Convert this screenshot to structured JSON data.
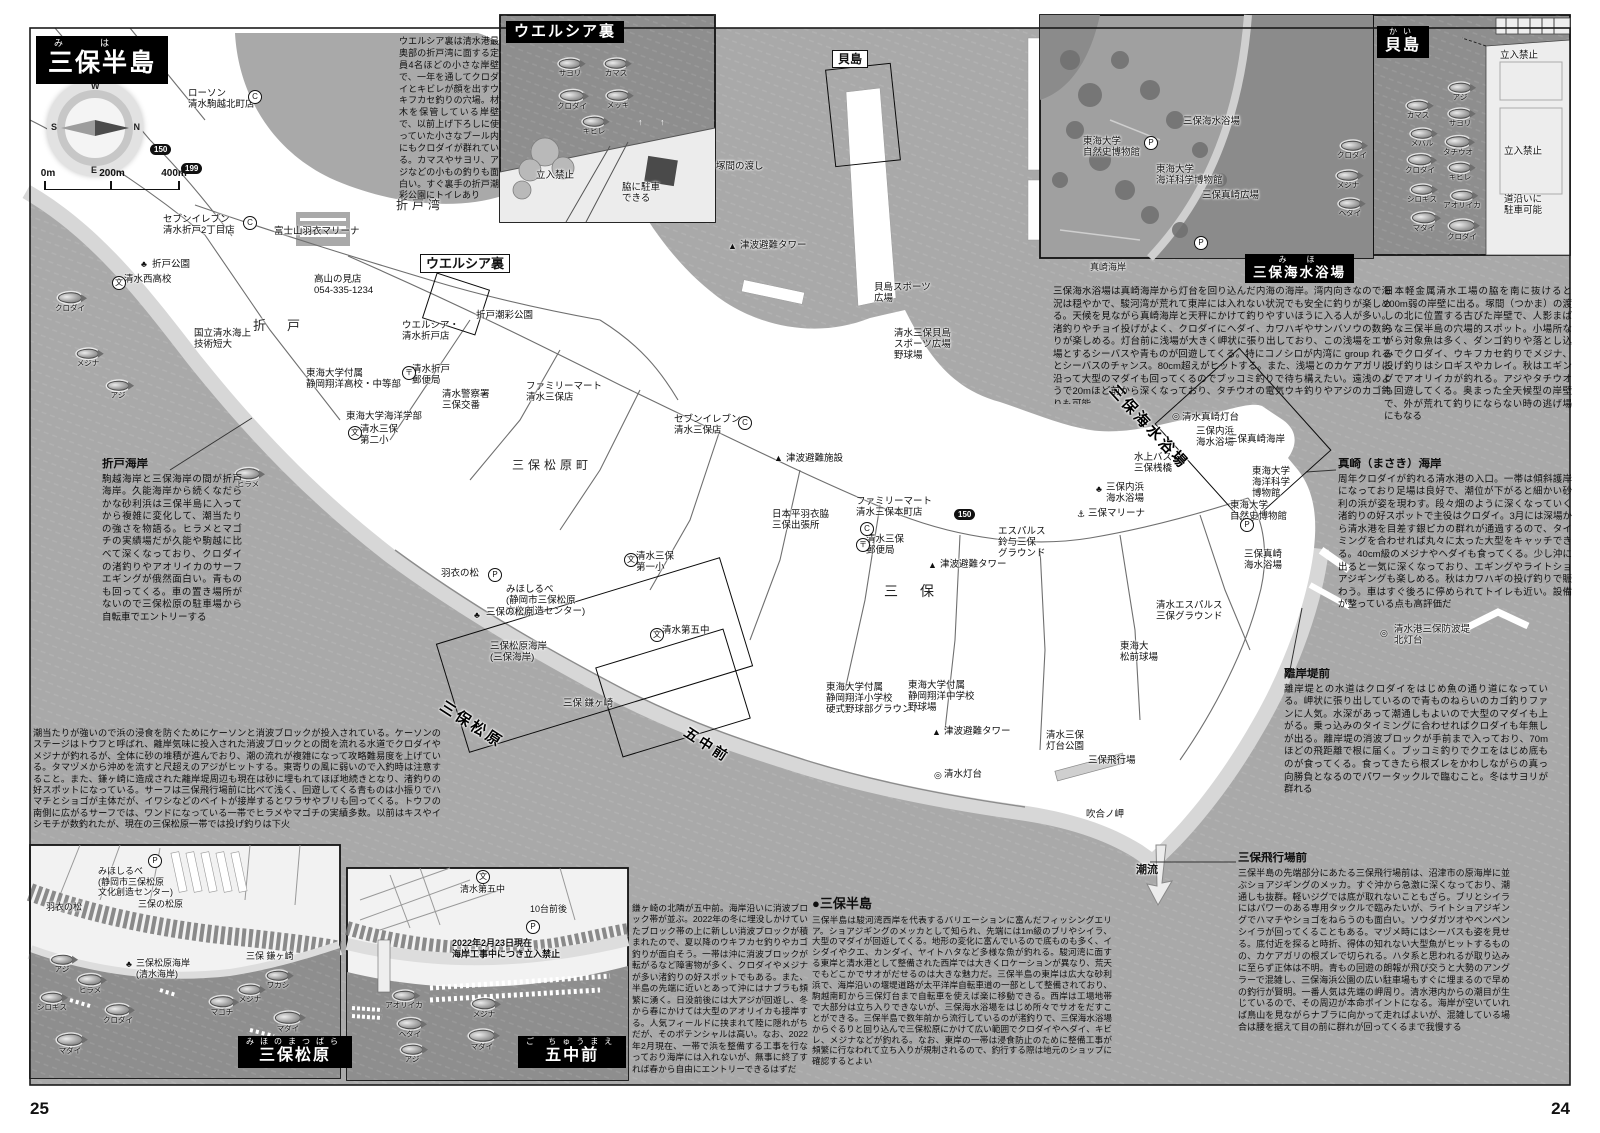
{
  "page_numbers": {
    "left": "25",
    "right": "24"
  },
  "title_block": {
    "furigana": "み　は",
    "title": "三保半島"
  },
  "compass": {
    "n": "N",
    "e": "E",
    "s": "S",
    "w": "W"
  },
  "scale_bar": {
    "t0": "0m",
    "t1": "200m",
    "t2": "400m"
  },
  "colors": {
    "water": "#a9a9a9",
    "inset_water": "#8e8e8e",
    "land": "#ffffff",
    "beach": "#d7d7d7",
    "ink": "#111111"
  },
  "inset_titles": {
    "welcia": {
      "title": "ウエルシア裏"
    },
    "kaijima": {
      "furigana": "かい",
      "title": "貝島"
    },
    "beach": {
      "furigana": "み　ほ",
      "title": "三保海水浴場"
    },
    "matsubara": {
      "furigana": "みほのまつばら",
      "title": "三保松原"
    },
    "gochumae": {
      "furigana": "ご ちゅうまえ",
      "title": "五中前"
    }
  },
  "blocks": {
    "welcia": {
      "body": "ウエルシア裏は清水港最奥部の折戸湾に面する定員4名ほどの小さな岸壁で、一年を通してクロダイとキビレが顔を出すウキフカセ釣りの穴場。材木を保管している岸壁で、以前上げ下ろしに使っていた小さなプール内にもクロダイが群れている。カマスやサヨリ、アジなどの小もの釣りも面白い。すぐ裏手の折戸潮彩公園にトイレあり"
    },
    "kaijima": {
      "body": "日本軽金属清水工場の脇を南に抜けると200m弱の岸壁に出る。塚間（つかま）の渡しの北に位置する古びた岸壁で、人影まばらな三保半島の穴場的スポット。小場所ながら対象魚は多く、ダンゴ釣りや落とし込みでクロダイ、ウキフカセ釣りでメジナ、投げ釣りはシロギスやカレイ。秋はエギングでアオリイカが釣れる。アジやタチウオも回遊してくる。奥まった全天候型の岸壁で、外が荒れて釣りにならない時の逃げ場にもなる"
    },
    "beach": {
      "body": "三保海水浴場は真崎海岸から灯台を回り込んだ内海の海岸。湾内向きなので海況は穏やかで、駿河湾が荒れて東岸には入れない状況でも安全に釣りが楽しめる。天候を見ながら真崎海岸と天秤にかけて釣りやすいほうに入る人が多い。渚釣りやチョイ投げがよく、クロダイにヘダイ、カワハギやサンバソウの数釣りが楽しめる。灯台前に浅場が大きく岬状に張り出しており、この浅場をエサ場とするシーバスや青ものが回遊してくる。特にコノシロが内湾に group れるとシーバスのチャンス。80cm超えがヒットする。また、浅場とのカケアガリに沿って大型のマダイも回ってくるのでブッコミ釣りで待ち構えたい。遠浅のようで20mほど前から深くなっており、タチウオの電気ウキ釣りやアジのカゴ釣りも可能"
    },
    "masaki": {
      "heading": "真崎（まさき）海岸",
      "body": "周年クロダイが釣れる清水港の入口。一帯は傾斜護岸になっており足場は良好で、潮位が下がると細かい砂利の浜が姿を現わす。段々畑のように深くなっていく渚釣りの好スポットで主役はクロダイ。3月には深場から清水港を目差す銀ピカの群れが通過するので、タイミングを合わせれば丸々に太った大型をキャッチできる。40cm級のメジナやヘダイも食ってくる。少し沖に出ると一気に深くなっており、エギングやライトショアジギングも楽しめる。秋はカワハギの投げ釣りで賑わう。車はすぐ後ろに停められてトイレも近い。設備が整っている点も高評価だ"
    },
    "rigantei": {
      "heading": "離岸堤前",
      "body": "離岸堤との水道はクロダイをはじめ魚の通り道になっている。岬状に張り出しているので青ものねらいのカゴ釣りファンに人気。水深があって潮通しもよいので大型のマダイも上がる。乗っ込みのタイミングに合わせればクロダイも年無しが出る。離岸堤の消波ブロックが手前まで入っており、70mほどの飛距離で根に届く。ブッコミ釣りでクエをはじめ底ものが食ってくる。食ってきたら根ズレをかわしながらの真っ向勝負となるのでパワータックルで臨むこと。冬はサヨリが群れる"
    },
    "airfield": {
      "heading": "三保飛行場前",
      "body": "三保半島の先端部分にあたる三保飛行場前は、沼津市の原海岸に並ぶショアジギングのメッカ。すぐ沖から急激に深くなっており、潮通しも抜群。軽いジグでは底が取れないこともざら。ブリとシイラにはパワーのある専用タックルで臨みたいが、ライトショアジギングでハマチやショゴをねらうのも面白い。ソウダガツオやペンペンシイラが回ってくることもある。マヅメ時にはシーバスも姿を見せる。底付近を探ると時折、得体の知れない大型魚がヒットするものの、カケアガリの根ズレで切られる。ハタ系と思われるが取り込みに至らず正体は不明。青もの回遊の朗報が飛び交うと大勢のアングラーで混雑し、三保海浜公園の広い駐車場もすぐに埋まるので早めの釣行が賢明。一番人気は先端の岬周り。清水港内からの潮目が生じているので、その周辺が本命ポイントになる。海岸が空いていれば鳥山を見ながらナブラに向かって走ればよいが、混雑している場合は腰を据えて目の前に群れが回ってくるまで我慢する"
    },
    "orido": {
      "heading": "折戸海岸",
      "body": "駒越海岸と三保海岸の間が折戸海岸。久能海岸から続くなだらかな砂利浜は三保半島に入ってから複雑に変化して、潮当たりの強さを物語る。ヒラメとマゴチの実績場だが久能や駒越に比べて深くなっており、クロダイの渚釣りやアオリイカのサーフエギングが俄然面白い。青ものも回ってくる。車の置き場所がないので三保松原の駐車場から自転車でエントリーする"
    },
    "matsubara": {
      "body": "潮当たりが強いので浜の浸食を防ぐためにケーソンと消波ブロックが投入されている。ケーソンのステージはトウフと呼ばれ、離岸気味に投入された消波ブロックとの間を流れる水道でクロダイやメジナが釣れるが、全体に砂の堆積が進んでおり、潮の流れが複雑になって攻略難易度を上げている。タマヅメから沖めを流すと尺超えのアジがヒットする。東寄りの風に弱いので入釣時は注意すること。また、鎌ヶ崎に造成された離岸堤周辺も現在は砂に埋もれてほぼ地続きとなり、渚釣りの好スポットになっている。サーフは三保飛行場前に比べて浅く、回遊してくる青ものは小振りでハマチとショゴが主体だが、イワシなどのベイトが接岸するとワラサやブリも回ってくる。トウフの南側に広がるサーフでは、ワンドになっている一帯でヒラメやマゴチの実績多数。以前はキスやイシモチが数釣れたが、現在の三保松原一帯では投げ釣りは下火"
    },
    "gochumae": {
      "body": "鎌ヶ崎の北隣が五中前。海岸沿いに消波ブロック帯が並ぶ。2022年の冬に埋没しかけていたブロック帯の上に新しい消波ブロックが積まれたので、夏以降のウキフカセ釣りやカゴ釣りが面白そう。一帯は沖に消波ブロックが転がるなど障害物が多く、クロダイやメジナが多い渚釣りの好スポットでもある。また、半島の先端に近いとあって沖にはナブラも頻繁に湧く。日没前後には大アジが回遊し、冬から春にかけては大型のアオリイカも接岸する。人気フィールドに挟まれて陸に隠れがちだが、そのポテンシャルは高い。なお、2022年2月現在、一帯で浜を整備する工事を行なっており海岸には入れないが、無事に終了すれば春から自由にエントリーできるはずだ"
    },
    "miho": {
      "heading": "●三保半島",
      "body": "三保半島は駿河湾西岸を代表するバリエーションに富んだフィッシングエリア。ショアジギングのメッカとして知られ、先端には1m級のブリやシイラ、大型のマダイが回遊してくる。地形の変化に富んでいるので底ものも多く、イシダイやクエ、カンダイ、ヤイトハタなど多様な魚が釣れる。駿河湾に面する東岸と清水港として整備された西岸では大きくロケーションが異なり、荒天でもどこかでサオがだせるのは大きな魅力だ。三保半島の東岸は広大な砂利浜で、海岸沿いの堰堤道路が太平洋岸自転車道の一部として整備されており、駒越南町から三保灯台まで自転車を使えば楽に移動できる。西岸は工場地帯で大部分は立ち入りできないが、三保海水浴場をはじめ所々でサオをだすことができる。三保半島で数年前から流行しているのが渚釣りで、三保海水浴場からぐるりと回り込んで三保松原にかけて広い範囲でクロダイやヘダイ、キビレ、メジナなどが釣れる。なお、東岸の一帯は浸食防止のために整備工事が頻繁に行なわれて立ち入りが規制されるので、釣行する際は地元のショップに確認するとよい"
    }
  },
  "map_labels": [
    {
      "t": "ローソン\n清水駒越北町店",
      "x": 188,
      "y": 88
    },
    {
      "t": "セブンイレブン\n清水折戸2丁目店",
      "x": 163,
      "y": 214
    },
    {
      "t": "折戸公園",
      "x": 152,
      "y": 259
    },
    {
      "t": "清水西高校",
      "x": 124,
      "y": 274
    },
    {
      "t": "富士山羽衣マリーナ",
      "x": 274,
      "y": 226
    },
    {
      "t": "高山の見店\n054-335-1234",
      "x": 314,
      "y": 274
    },
    {
      "t": "折　戸",
      "x": 253,
      "y": 318,
      "fs": 13,
      "c": "sp"
    },
    {
      "t": "ウエルシア裏",
      "x": 420,
      "y": 254,
      "fs": 13,
      "c": "b bx",
      "n": "welcia-map-tag"
    },
    {
      "t": "ウエルシア・\n清水折戸店",
      "x": 402,
      "y": 320
    },
    {
      "t": "折戸潮彩公園",
      "x": 476,
      "y": 310
    },
    {
      "t": "折戸湾",
      "x": 396,
      "y": 198,
      "fs": 12,
      "c": "sp"
    },
    {
      "t": "国立清水海上\n技術短大",
      "x": 194,
      "y": 328
    },
    {
      "t": "東海大学付属\n静岡翔洋高校・中等部",
      "x": 306,
      "y": 368
    },
    {
      "t": "東海大学海洋学部",
      "x": 346,
      "y": 411
    },
    {
      "t": "清水折戸\n郵便局",
      "x": 412,
      "y": 364
    },
    {
      "t": "清水警察署\n三保交番",
      "x": 442,
      "y": 389
    },
    {
      "t": "清水三保\n第二小",
      "x": 360,
      "y": 424
    },
    {
      "t": "ファミリーマート\n清水三保店",
      "x": 526,
      "y": 381
    },
    {
      "t": "セブンイレブン\n清水三保店",
      "x": 674,
      "y": 414
    },
    {
      "t": "三保松原町",
      "x": 512,
      "y": 458,
      "fs": 12,
      "c": "sp"
    },
    {
      "t": "津波避難施設",
      "x": 786,
      "y": 453
    },
    {
      "t": "津波避難タワー",
      "x": 740,
      "y": 240
    },
    {
      "t": "塚間の渡し",
      "x": 716,
      "y": 161
    },
    {
      "t": "貝島",
      "x": 832,
      "y": 50,
      "fs": 12,
      "c": "b bx",
      "n": "kaijima-map-tag"
    },
    {
      "t": "貝島スポーツ\n広場",
      "x": 874,
      "y": 282
    },
    {
      "t": "清水三保貝島\nスポーツ広場\n野球場",
      "x": 894,
      "y": 328
    },
    {
      "t": "日本平羽衣脇\n三保出張所",
      "x": 772,
      "y": 509
    },
    {
      "t": "ファミリーマート\n清水三保本町店",
      "x": 856,
      "y": 496
    },
    {
      "t": "清水三保\n郵便局",
      "x": 866,
      "y": 534
    },
    {
      "t": "エスパルス\n鈴与三保\nグラウンド",
      "x": 998,
      "y": 526
    },
    {
      "t": "津波避難タワー",
      "x": 940,
      "y": 559
    },
    {
      "t": "三保マリーナ",
      "x": 1088,
      "y": 508
    },
    {
      "t": "三保内浜\n海水浴場",
      "x": 1106,
      "y": 482
    },
    {
      "t": "水上バス\n三保桟橋",
      "x": 1134,
      "y": 452
    },
    {
      "t": "三保内浜\n海水浴場",
      "x": 1196,
      "y": 426
    },
    {
      "t": "三保真崎海岸",
      "x": 1228,
      "y": 434
    },
    {
      "t": "清水真崎灯台",
      "x": 1182,
      "y": 412
    },
    {
      "t": "東海大学\n海洋科学\n博物館",
      "x": 1252,
      "y": 466
    },
    {
      "t": "東海大学\n自然史博物館",
      "x": 1230,
      "y": 500
    },
    {
      "t": "清水エスパルス\n三保グラウンド",
      "x": 1156,
      "y": 600
    },
    {
      "t": "三　保",
      "x": 884,
      "y": 583,
      "fs": 14,
      "c": "sp"
    },
    {
      "t": "東海大\n松前球場",
      "x": 1120,
      "y": 641
    },
    {
      "t": "三保真崎\n海水浴場",
      "x": 1244,
      "y": 549
    },
    {
      "t": "清水港三保防波堤\n北灯台",
      "x": 1394,
      "y": 624
    },
    {
      "t": "東海大学付属\n静岡翔洋小学校\n硬式野球部グラウンド",
      "x": 826,
      "y": 682
    },
    {
      "t": "東海大学付属\n静岡翔洋中学校\n野球場",
      "x": 908,
      "y": 680
    },
    {
      "t": "津波避難タワー",
      "x": 944,
      "y": 726
    },
    {
      "t": "清水三保\n灯台公園",
      "x": 1046,
      "y": 730
    },
    {
      "t": "三保飛行場",
      "x": 1088,
      "y": 755
    },
    {
      "t": "清水灯台",
      "x": 944,
      "y": 769
    },
    {
      "t": "吹合ノ岬",
      "x": 1086,
      "y": 809
    },
    {
      "t": "潮流",
      "x": 1136,
      "y": 864,
      "fs": 11,
      "c": "b"
    },
    {
      "t": "羽衣の松",
      "x": 441,
      "y": 568
    },
    {
      "t": "みほしるべ\n(静岡市三保松原\n文化創造センター)",
      "x": 506,
      "y": 584
    },
    {
      "t": "三保の松原",
      "x": 486,
      "y": 607
    },
    {
      "t": "清水第五中",
      "x": 662,
      "y": 625
    },
    {
      "t": "三保松原海岸\n(三保海岸)",
      "x": 490,
      "y": 641
    },
    {
      "t": "三保 鎌ヶ崎",
      "x": 563,
      "y": 698
    },
    {
      "t": "清水三保\n第一小",
      "x": 636,
      "y": 551
    },
    {
      "t": "三保海水浴場",
      "x": 1118,
      "y": 382,
      "rot": 47,
      "fs": 15,
      "c": "dg"
    },
    {
      "t": "三保松原",
      "x": 446,
      "y": 698,
      "rot": 33,
      "fs": 15,
      "c": "dg"
    },
    {
      "t": "五中前",
      "x": 690,
      "y": 724,
      "rot": 33,
      "fs": 14,
      "c": "dg"
    },
    {
      "t": "三保海水浴場",
      "x": 1183,
      "y": 116
    },
    {
      "t": "東海大学\n自然史博物館",
      "x": 1083,
      "y": 136
    },
    {
      "t": "東海大学\n海洋科学博物館",
      "x": 1156,
      "y": 164
    },
    {
      "t": "三保真崎広場",
      "x": 1202,
      "y": 190
    },
    {
      "t": "真崎海岸",
      "x": 1090,
      "y": 262,
      "fs": 9
    },
    {
      "t": "立入禁止",
      "x": 1500,
      "y": 50
    },
    {
      "t": "立入禁止",
      "x": 1504,
      "y": 146
    },
    {
      "t": "道沿いに\n駐車可能",
      "x": 1504,
      "y": 194
    },
    {
      "t": "立入禁止",
      "x": 536,
      "y": 170
    },
    {
      "t": "脇に駐車\nできる",
      "x": 622,
      "y": 182
    },
    {
      "t": "みほしるべ\n(静岡市三保松原\n文化創造センター)",
      "x": 98,
      "y": 866,
      "fs": 9
    },
    {
      "t": "羽衣の松",
      "x": 46,
      "y": 902,
      "fs": 9
    },
    {
      "t": "三保の松原",
      "x": 138,
      "y": 899,
      "fs": 9
    },
    {
      "t": "三保松原海岸\n(清水海岸)",
      "x": 136,
      "y": 958,
      "fs": 9
    },
    {
      "t": "三保 鎌ヶ崎",
      "x": 246,
      "y": 951,
      "fs": 9
    },
    {
      "t": "清水第五中",
      "x": 460,
      "y": 884,
      "fs": 9
    },
    {
      "t": "10台前後",
      "x": 530,
      "y": 904,
      "fs": 9
    },
    {
      "t": "2022年2月23日現在\n海岸工事中につき立入禁止",
      "x": 452,
      "y": 938,
      "fs": 9,
      "c": "b"
    }
  ],
  "fish": [
    {
      "t": "サヨリ",
      "x": 570,
      "y": 68,
      "s": 0.9
    },
    {
      "t": "カマス",
      "x": 616,
      "y": 68,
      "s": 0.9
    },
    {
      "t": "クロダイ",
      "x": 572,
      "y": 100,
      "s": 1
    },
    {
      "t": "メッキ",
      "x": 618,
      "y": 100,
      "s": 0.9
    },
    {
      "t": "キビレ",
      "x": 594,
      "y": 126,
      "s": 0.9
    },
    {
      "t": "アジ",
      "x": 1460,
      "y": 92,
      "s": 0.9
    },
    {
      "t": "カマス",
      "x": 1418,
      "y": 110,
      "s": 0.9
    },
    {
      "t": "サヨリ",
      "x": 1460,
      "y": 118,
      "s": 0.9
    },
    {
      "t": "メバル",
      "x": 1422,
      "y": 138,
      "s": 0.9
    },
    {
      "t": "タチウオ",
      "x": 1458,
      "y": 146,
      "s": 1
    },
    {
      "t": "クロダイ",
      "x": 1420,
      "y": 164,
      "s": 1
    },
    {
      "t": "キビレ",
      "x": 1460,
      "y": 172,
      "s": 0.9
    },
    {
      "t": "シロギス",
      "x": 1422,
      "y": 194,
      "s": 0.9
    },
    {
      "t": "アオリイカ",
      "x": 1462,
      "y": 200,
      "s": 0.9
    },
    {
      "t": "マダイ",
      "x": 1424,
      "y": 222,
      "s": 1
    },
    {
      "t": "クロダイ",
      "x": 1462,
      "y": 230,
      "s": 1.1
    },
    {
      "t": "クロダイ",
      "x": 1352,
      "y": 150,
      "s": 0.9
    },
    {
      "t": "メジナ",
      "x": 1348,
      "y": 180,
      "s": 0.9
    },
    {
      "t": "ヘダイ",
      "x": 1350,
      "y": 208,
      "s": 0.9
    },
    {
      "t": "クロダイ",
      "x": 70,
      "y": 302,
      "s": 1
    },
    {
      "t": "メジナ",
      "x": 88,
      "y": 358,
      "s": 0.9
    },
    {
      "t": "アジ",
      "x": 118,
      "y": 390,
      "s": 0.9
    },
    {
      "t": "ヒラメ",
      "x": 248,
      "y": 478,
      "s": 1
    },
    {
      "t": "アジ",
      "x": 62,
      "y": 964,
      "s": 0.9
    },
    {
      "t": "ヒラメ",
      "x": 90,
      "y": 984,
      "s": 1
    },
    {
      "t": "シロギス",
      "x": 52,
      "y": 1002,
      "s": 0.9
    },
    {
      "t": "クロダイ",
      "x": 118,
      "y": 1014,
      "s": 1
    },
    {
      "t": "マダイ",
      "x": 70,
      "y": 1044,
      "s": 1.1
    },
    {
      "t": "メジナ",
      "x": 250,
      "y": 994,
      "s": 0.9
    },
    {
      "t": "ワカシ",
      "x": 278,
      "y": 980,
      "s": 0.9
    },
    {
      "t": "マゴチ",
      "x": 222,
      "y": 1006,
      "s": 1
    },
    {
      "t": "マダイ",
      "x": 288,
      "y": 1022,
      "s": 1.1
    },
    {
      "t": "アオリイカ",
      "x": 404,
      "y": 1000,
      "s": 0.9
    },
    {
      "t": "ヘダイ",
      "x": 410,
      "y": 1028,
      "s": 1
    },
    {
      "t": "アジ",
      "x": 412,
      "y": 1054,
      "s": 0.9
    },
    {
      "t": "メジナ",
      "x": 484,
      "y": 1008,
      "s": 1
    },
    {
      "t": "マダイ",
      "x": 482,
      "y": 1040,
      "s": 1.1
    }
  ],
  "badges": [
    {
      "t": "150",
      "x": 150,
      "y": 144
    },
    {
      "t": "199",
      "x": 181,
      "y": 163
    },
    {
      "t": "150",
      "x": 954,
      "y": 509
    }
  ],
  "icons": [
    {
      "g": "C",
      "x": 248,
      "y": 90,
      "c": "circ"
    },
    {
      "g": "C",
      "x": 243,
      "y": 216,
      "c": "circ"
    },
    {
      "g": "C",
      "x": 738,
      "y": 416,
      "c": "circ"
    },
    {
      "g": "C",
      "x": 860,
      "y": 522,
      "c": "circ"
    },
    {
      "g": "文",
      "x": 112,
      "y": 276,
      "c": "circ"
    },
    {
      "g": "文",
      "x": 348,
      "y": 426,
      "c": "circ"
    },
    {
      "g": "文",
      "x": 624,
      "y": 553,
      "c": "circ"
    },
    {
      "g": "文",
      "x": 650,
      "y": 628,
      "c": "circ"
    },
    {
      "g": "文",
      "x": 476,
      "y": 870,
      "c": "circ"
    },
    {
      "g": "〒",
      "x": 402,
      "y": 366,
      "c": "circ"
    },
    {
      "g": "〒",
      "x": 856,
      "y": 538,
      "c": "circ"
    },
    {
      "g": "P",
      "x": 148,
      "y": 854,
      "c": "circ"
    },
    {
      "g": "P",
      "x": 488,
      "y": 568,
      "c": "circ"
    },
    {
      "g": "P",
      "x": 1144,
      "y": 136,
      "c": "circ"
    },
    {
      "g": "P",
      "x": 1194,
      "y": 236,
      "c": "circ"
    },
    {
      "g": "P",
      "x": 526,
      "y": 920,
      "c": "circ"
    },
    {
      "g": "P",
      "x": 1240,
      "y": 518,
      "c": "circ"
    },
    {
      "g": "◎",
      "x": 934,
      "y": 771
    },
    {
      "g": "◎",
      "x": 1172,
      "y": 412
    },
    {
      "g": "◎",
      "x": 1380,
      "y": 629
    },
    {
      "g": "♣",
      "x": 141,
      "y": 260
    },
    {
      "g": "♣",
      "x": 1096,
      "y": 485
    },
    {
      "g": "♣",
      "x": 126,
      "y": 960
    },
    {
      "g": "♣",
      "x": 474,
      "y": 611
    },
    {
      "g": "⚓",
      "x": 1077,
      "y": 510
    },
    {
      "g": "▲",
      "x": 728,
      "y": 242
    },
    {
      "g": "▲",
      "x": 774,
      "y": 454
    },
    {
      "g": "▲",
      "x": 928,
      "y": 561
    },
    {
      "g": "▲",
      "x": 932,
      "y": 728
    },
    {
      "g": "↑",
      "x": 638,
      "y": 118,
      "c": "wt"
    },
    {
      "g": "↑",
      "x": 660,
      "y": 118,
      "c": "wt"
    }
  ]
}
